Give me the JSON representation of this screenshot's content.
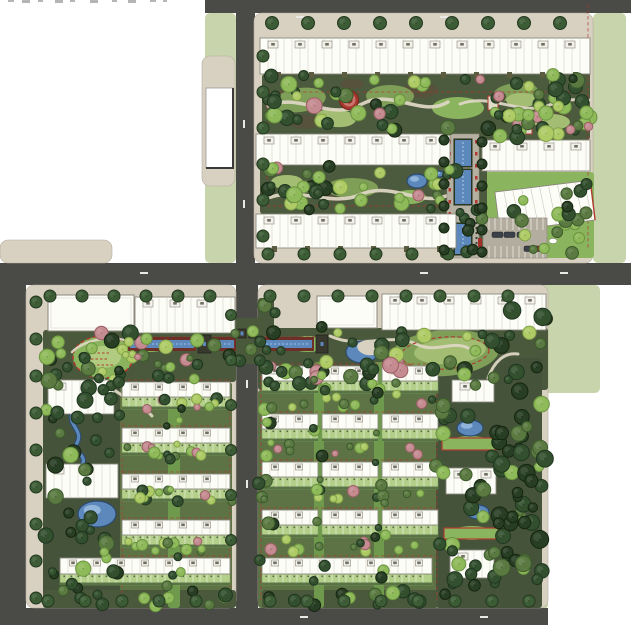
{
  "canvas": {
    "w": 631,
    "h": 625,
    "bg": "#ffffff"
  },
  "palette": {
    "road": "#4a4a47",
    "walk": "#d5cdbe",
    "sage": "#c8d4ab",
    "pad": "#d8d1c2",
    "gBase": "#4c5a3d",
    "gBand": "#4a583b",
    "gTown": "#5d7346",
    "gFinger": "#6f9a4e",
    "gTower": "#45533a",
    "lawn1": "#7f9e58",
    "lawn2": "#a3bd72",
    "lawn3": "#8ab45e",
    "lawn4": "#b1cc80",
    "soil": "#5f4a3c",
    "path": "#ddd6c2",
    "red": "#b03a30",
    "darkRed": "#6e2f28",
    "water": "#5c88bb",
    "waterDark": "#2c4a6e",
    "waterLight": "#9fc0e2",
    "bldg": "#fdfdf8",
    "bldgLine": "#8a877c",
    "bldgInner": "#c9c6ba",
    "bldgDark": "#6f6f62",
    "olive": "#5c5c40",
    "plot": "#b3cf8a",
    "plotLine": "#e8efdc",
    "plotDark": "#4a643c",
    "plotDot": "#55684a",
    "structure": "#38382f",
    "car": "#3b4049",
    "carRed": "#7a2e28",
    "parking": "#b3ada0",
    "trees": {
      "dark": [
        "#33502e",
        "#1f3520"
      ],
      "deep": [
        "#283e24",
        "#15250f"
      ],
      "mid": [
        "#5a7a41",
        "#3c5a2c"
      ],
      "light": [
        "#8fba5a",
        "#6a9440"
      ],
      "yellow": [
        "#aecb66",
        "#83a34b"
      ],
      "pink": [
        "#c48b90",
        "#9c6066"
      ],
      "street": [
        "#3c5c35",
        "#24391f"
      ]
    },
    "kindsets": {
      "mixed": [
        "dark",
        "deep",
        "mid",
        "light",
        "yellow",
        "dark",
        "light",
        "pink"
      ],
      "mixed2": [
        "dark",
        "mid",
        "light",
        "yellow"
      ],
      "darkish": [
        "dark",
        "deep",
        "dark",
        "mid",
        "light"
      ],
      "deepish": [
        "deep",
        "dark",
        "deep",
        "mid"
      ],
      "band": [
        "light",
        "yellow",
        "dark",
        "mid",
        "pink"
      ]
    }
  },
  "sage": [
    [
      205,
      13,
      31,
      250
    ],
    [
      593,
      13,
      33,
      250
    ],
    [
      505,
      285,
      95,
      108
    ],
    [
      505,
      393,
      43,
      217
    ]
  ],
  "roads": [
    [
      205,
      0,
      426,
      13
    ],
    [
      236,
      12,
      19,
      253
    ],
    [
      0,
      263,
      631,
      22
    ],
    [
      0,
      285,
      26,
      325
    ],
    [
      236,
      285,
      22,
      325
    ],
    [
      0,
      608,
      548,
      17
    ]
  ],
  "pads": [
    [
      202,
      56,
      33,
      130
    ],
    [
      0,
      240,
      112,
      23
    ],
    [
      254,
      13,
      339,
      250
    ],
    [
      26,
      285,
      210,
      323
    ],
    [
      258,
      285,
      290,
      323
    ]
  ],
  "zones": [
    {
      "r": [
        262,
        74,
        324,
        62
      ],
      "c": "gBase"
    },
    {
      "r": [
        260,
        164,
        198,
        50
      ],
      "c": "gBase"
    },
    {
      "r": [
        478,
        70,
        112,
        70
      ],
      "c": "gBase"
    },
    {
      "r": [
        478,
        172,
        116,
        86
      ],
      "c": "lawn3"
    },
    {
      "r": [
        43,
        330,
        193,
        52
      ],
      "c": "gBand"
    },
    {
      "r": [
        43,
        380,
        77,
        228
      ],
      "c": "gTower"
    },
    {
      "r": [
        120,
        382,
        112,
        226
      ],
      "c": "gTown"
    },
    {
      "r": [
        258,
        328,
        290,
        62
      ],
      "c": "gBand"
    },
    {
      "r": [
        258,
        390,
        180,
        218
      ],
      "c": "gTown"
    },
    {
      "r": [
        436,
        358,
        106,
        250
      ],
      "c": "gTower"
    },
    {
      "r": [
        258,
        298,
        16,
        30
      ],
      "c": "gBand"
    },
    {
      "r": [
        232,
        318,
        30,
        46
      ],
      "c": "gBand"
    },
    {
      "r": [
        440,
        134,
        7,
        124
      ],
      "c": "gBase"
    },
    {
      "r": [
        479,
        134,
        8,
        124
      ],
      "c": "gBase"
    },
    {
      "r": [
        43,
        590,
        193,
        18
      ],
      "c": "gBand"
    },
    {
      "r": [
        262,
        590,
        176,
        18
      ],
      "c": "gBand"
    }
  ],
  "fingers": [
    [
      168,
      382,
      12,
      226
    ],
    [
      314,
      362,
      10,
      246
    ],
    [
      374,
      362,
      10,
      246
    ]
  ],
  "soil": [
    [
      305,
      122,
      16,
      7
    ],
    [
      420,
      90,
      18,
      8
    ],
    [
      556,
      115,
      14,
      6
    ],
    [
      352,
      84,
      12,
      5
    ],
    [
      336,
      196,
      14,
      6
    ]
  ],
  "lawns": [
    [
      300,
      100,
      26,
      12,
      "lawn1",
      -8
    ],
    [
      336,
      118,
      20,
      9,
      "lawn2",
      5
    ],
    [
      390,
      96,
      24,
      11,
      "lawn1",
      0
    ],
    [
      458,
      108,
      26,
      11,
      "lawn3",
      0
    ],
    [
      516,
      92,
      22,
      9,
      "lawn1",
      -5
    ],
    [
      552,
      122,
      18,
      8,
      "lawn2",
      0
    ],
    [
      287,
      182,
      16,
      7,
      "lawn2",
      0
    ],
    [
      352,
      188,
      26,
      10,
      "lawn1",
      0
    ],
    [
      410,
      197,
      16,
      7,
      "lawn3",
      0
    ],
    [
      522,
      100,
      16,
      7,
      "lawn2",
      0
    ],
    [
      150,
      345,
      18,
      7,
      "lawn3",
      0
    ],
    [
      445,
      353,
      54,
      23,
      "lawn1",
      -4
    ],
    [
      450,
      351,
      36,
      13,
      "lawn2",
      -4
    ],
    [
      308,
      344,
      20,
      8,
      "lawn3",
      0
    ],
    [
      470,
      443,
      20,
      7,
      "lawn3",
      0
    ],
    [
      472,
      533,
      20,
      7,
      "lawn3",
      0
    ],
    [
      548,
      240,
      24,
      12,
      "lawn3",
      0
    ]
  ],
  "track": {
    "cx": 103,
    "cy": 357,
    "rx": 30,
    "ry": 21
  },
  "paths": [
    [
      "M268,106 C300,92 330,122 362,104 C392,88 422,118 448,102",
      3.5
    ],
    [
      "M460,104 C492,92 522,118 552,104 C572,96 584,102 590,100",
      3
    ],
    [
      "M268,198 C300,186 332,208 362,194 C392,182 420,206 446,196",
      3.5
    ],
    [
      "M104,380 C116,396 140,402 152,416",
      3
    ],
    [
      "M330,336 C360,350 392,332 416,344 C436,354 452,340 468,348",
      3
    ],
    [
      "M488,378 C494,362 504,352 518,354",
      3
    ],
    [
      "M72,352 C86,338 118,334 134,344",
      2.5
    ]
  ],
  "red_lines": [
    [
      588,
      4,
      588,
      248
    ],
    [
      267,
      92,
      585,
      92
    ],
    [
      267,
      92,
      267,
      206
    ],
    [
      267,
      206,
      450,
      206
    ],
    [
      130,
      337,
      234,
      337
    ],
    [
      258,
      337,
      316,
      337
    ],
    [
      122,
      380,
      230,
      380
    ],
    [
      122,
      426,
      230,
      426
    ],
    [
      122,
      472,
      230,
      472
    ],
    [
      122,
      518,
      230,
      518
    ],
    [
      122,
      556,
      230,
      556
    ],
    [
      122,
      380,
      122,
      600
    ],
    [
      230,
      380,
      230,
      600
    ],
    [
      261,
      364,
      437,
      364
    ],
    [
      261,
      412,
      437,
      412
    ],
    [
      261,
      460,
      437,
      460
    ],
    [
      261,
      508,
      437,
      508
    ],
    [
      261,
      556,
      437,
      556
    ],
    [
      261,
      364,
      261,
      600
    ],
    [
      437,
      364,
      437,
      600
    ],
    [
      480,
      60,
      586,
      60
    ]
  ],
  "red_loop": {
    "cx": 445,
    "cy": 353,
    "rx": 44,
    "ry": 16,
    "rot": -4
  },
  "pergolas": [
    [
      442,
      438,
      54,
      12
    ],
    [
      444,
      528,
      54,
      11
    ]
  ],
  "pavilions_red": [
    [
      488,
      96,
      10,
      14
    ],
    [
      524,
      124,
      8,
      10
    ]
  ],
  "linear_water": [
    [
      128,
      337,
      68,
      14
    ],
    [
      212,
      337,
      24,
      14
    ],
    [
      262,
      337,
      52,
      14
    ]
  ],
  "ponds": [
    [
      417,
      181,
      10,
      7
    ],
    [
      439,
      174,
      5,
      3
    ],
    [
      97,
      514,
      19,
      13
    ],
    [
      470,
      428,
      13,
      8
    ],
    [
      478,
      512,
      11,
      7
    ]
  ],
  "crescent": {
    "cx": 362,
    "cy": 352,
    "rx": 16,
    "ry": 11,
    "hx": 368,
    "hy": 348,
    "hrx": 11,
    "hry": 7
  },
  "stream": "M73,412 C66,424 84,430 77,443 C72,452 86,454 83,463",
  "axis": {
    "pad": [
      447,
      134,
      32,
      124
    ],
    "waters": [
      [
        455,
        140,
        16,
        26
      ],
      [
        455,
        170,
        16,
        34
      ],
      [
        455,
        224,
        16,
        30
      ]
    ],
    "ticksY": [
      140,
      152,
      164,
      176,
      188,
      200,
      212
    ],
    "colY": [
      218,
      254,
      5
    ],
    "gates": [
      [
        446,
        238,
        4,
        9
      ],
      [
        478,
        238,
        4,
        9
      ]
    ]
  },
  "plain_buildings": [
    [
      48,
      295,
      86,
      36
    ],
    [
      317,
      296,
      60,
      32
    ]
  ],
  "tl_building": {
    "x": 206,
    "y": 88,
    "w": 27,
    "h": 80
  },
  "slabs": [
    [
      260,
      38,
      330,
      36,
      1
    ],
    [
      256,
      134,
      194,
      31,
      0
    ],
    [
      482,
      140,
      108,
      31,
      0
    ],
    [
      256,
      214,
      200,
      34,
      1
    ],
    [
      135,
      297,
      100,
      36,
      0
    ],
    [
      382,
      294,
      164,
      36,
      0
    ],
    [
      48,
      380,
      66,
      34,
      0
    ],
    [
      46,
      464,
      72,
      34,
      0
    ],
    [
      122,
      382,
      108,
      15,
      0
    ],
    [
      122,
      428,
      108,
      15,
      0
    ],
    [
      122,
      474,
      108,
      15,
      0
    ],
    [
      122,
      520,
      108,
      15,
      0
    ],
    [
      60,
      558,
      170,
      16,
      0
    ],
    [
      262,
      366,
      56,
      15,
      0
    ],
    [
      322,
      366,
      56,
      15,
      0
    ],
    [
      382,
      366,
      56,
      15,
      0
    ],
    [
      262,
      414,
      56,
      15,
      0
    ],
    [
      322,
      414,
      56,
      15,
      0
    ],
    [
      382,
      414,
      56,
      15,
      0
    ],
    [
      262,
      462,
      56,
      15,
      0
    ],
    [
      322,
      462,
      56,
      15,
      0
    ],
    [
      382,
      462,
      56,
      15,
      0
    ],
    [
      262,
      510,
      56,
      15,
      0
    ],
    [
      322,
      510,
      56,
      15,
      0
    ],
    [
      382,
      510,
      56,
      15,
      0
    ],
    [
      262,
      558,
      170,
      16,
      0
    ],
    [
      452,
      380,
      42,
      22,
      0
    ],
    [
      446,
      468,
      50,
      26,
      0
    ],
    [
      450,
      550,
      44,
      28,
      0
    ]
  ],
  "clubhouse": {
    "x": 497,
    "y": 186,
    "w": 96,
    "h": 40,
    "rot": -7
  },
  "plots": [
    [
      122,
      397,
      108,
      12
    ],
    [
      122,
      443,
      108,
      12
    ],
    [
      122,
      489,
      108,
      12
    ],
    [
      122,
      535,
      108,
      12
    ],
    [
      60,
      574,
      170,
      11
    ],
    [
      262,
      381,
      56,
      12
    ],
    [
      322,
      381,
      56,
      12
    ],
    [
      382,
      381,
      56,
      12
    ],
    [
      262,
      429,
      56,
      12
    ],
    [
      322,
      429,
      56,
      12
    ],
    [
      382,
      429,
      56,
      12
    ],
    [
      262,
      477,
      56,
      12
    ],
    [
      322,
      477,
      56,
      12
    ],
    [
      382,
      477,
      56,
      12
    ],
    [
      262,
      525,
      56,
      12
    ],
    [
      322,
      525,
      56,
      12
    ],
    [
      382,
      525,
      56,
      12
    ],
    [
      262,
      574,
      170,
      11
    ]
  ],
  "parking": {
    "x": 483,
    "y": 218,
    "w": 64,
    "h": 40
  },
  "cars": [
    [
      492,
      232,
      0
    ],
    [
      504,
      232,
      0
    ],
    [
      517,
      232,
      0
    ],
    [
      524,
      246,
      0
    ],
    [
      535,
      246,
      1
    ]
  ],
  "structures": [
    [
      198,
      335,
      13,
      18
    ],
    [
      316,
      335,
      12,
      18
    ],
    [
      238,
      329,
      8,
      9
    ],
    [
      249,
      329,
      8,
      9
    ]
  ],
  "plaza": {
    "cx": 349,
    "cy": 100
  },
  "sculpture": {
    "cx": 553,
    "cy": 241,
    "rx": 4,
    "ry": 2.5
  },
  "tree_rows": [
    {
      "x": 272,
      "y": 23,
      "dx": 36,
      "dy": 0,
      "n": 9,
      "k": "street",
      "r": 6.5
    },
    {
      "x": 263,
      "y": 56,
      "dx": 0,
      "dy": 36,
      "n": 6,
      "k": "street",
      "r": 6
    },
    {
      "x": 268,
      "y": 254,
      "dx": 36,
      "dy": 0,
      "n": 6,
      "k": "street",
      "r": 6
    },
    {
      "x": 50,
      "y": 296,
      "dx": 32,
      "dy": 0,
      "n": 6,
      "k": "street",
      "r": 6
    },
    {
      "x": 270,
      "y": 296,
      "dx": 34,
      "dy": 0,
      "n": 8,
      "k": "street",
      "r": 6
    },
    {
      "x": 36,
      "y": 302,
      "dx": 0,
      "dy": 37,
      "n": 9,
      "k": "street",
      "r": 6
    },
    {
      "x": 231,
      "y": 315,
      "dx": 0,
      "dy": 45,
      "n": 6,
      "k": "street",
      "r": 5.5
    },
    {
      "x": 48,
      "y": 601,
      "dx": 37,
      "dy": 0,
      "n": 5,
      "k": "street",
      "r": 6
    },
    {
      "x": 270,
      "y": 601,
      "dx": 37,
      "dy": 0,
      "n": 8,
      "k": "street",
      "r": 6
    },
    {
      "x": 444,
      "y": 140,
      "dx": 0,
      "dy": 22,
      "n": 6,
      "k": "deep",
      "r": 5
    },
    {
      "x": 482,
      "y": 142,
      "dx": 0,
      "dy": 22,
      "n": 6,
      "k": "deep",
      "r": 5
    }
  ],
  "tree_scatter": [
    [
      262,
      74,
      324,
      60,
      55,
      "mixed",
      4,
      8
    ],
    [
      260,
      164,
      196,
      48,
      38,
      "mixed",
      4,
      8
    ],
    [
      478,
      70,
      112,
      68,
      26,
      "mixed",
      4,
      8
    ],
    [
      478,
      196,
      116,
      58,
      13,
      "mixed2",
      4,
      7
    ],
    [
      558,
      176,
      36,
      48,
      8,
      "darkish",
      4,
      7
    ],
    [
      43,
      330,
      193,
      50,
      32,
      "mixed",
      4,
      8
    ],
    [
      43,
      380,
      77,
      226,
      42,
      "darkish",
      4,
      8
    ],
    [
      120,
      352,
      112,
      16,
      9,
      "band",
      3,
      6
    ],
    [
      120,
      398,
      112,
      14,
      9,
      "band",
      3,
      6
    ],
    [
      120,
      444,
      112,
      14,
      9,
      "band",
      3,
      6
    ],
    [
      120,
      490,
      112,
      14,
      9,
      "band",
      3,
      6
    ],
    [
      120,
      536,
      112,
      18,
      11,
      "band",
      3,
      6
    ],
    [
      55,
      590,
      178,
      16,
      11,
      "darkish",
      4,
      7
    ],
    [
      166,
      382,
      16,
      222,
      13,
      "darkish",
      3,
      6
    ],
    [
      258,
      326,
      290,
      58,
      44,
      "mixed",
      4,
      8
    ],
    [
      260,
      394,
      178,
      14,
      10,
      "band",
      3,
      6
    ],
    [
      260,
      442,
      178,
      14,
      10,
      "band",
      3,
      6
    ],
    [
      260,
      490,
      178,
      14,
      10,
      "band",
      3,
      6
    ],
    [
      260,
      536,
      178,
      16,
      12,
      "band",
      3,
      6
    ],
    [
      262,
      590,
      176,
      16,
      11,
      "darkish",
      4,
      7
    ],
    [
      312,
      360,
      14,
      230,
      13,
      "darkish",
      3,
      6
    ],
    [
      372,
      360,
      14,
      230,
      13,
      "darkish",
      3,
      6
    ],
    [
      436,
      358,
      106,
      246,
      48,
      "darkish",
      4,
      8
    ],
    [
      492,
      292,
      54,
      308,
      38,
      "deepish",
      5,
      9
    ],
    [
      258,
      298,
      18,
      290,
      15,
      "darkish",
      4,
      7
    ],
    [
      232,
      320,
      30,
      42,
      5,
      "darkish",
      4,
      6
    ],
    [
      455,
      196,
      24,
      58,
      8,
      "darkish",
      4,
      6
    ]
  ],
  "road_dashes": [
    [
      296,
      16,
      8,
      2
    ],
    [
      440,
      16,
      8,
      2
    ],
    [
      243,
      120,
      2,
      8
    ],
    [
      243,
      200,
      2,
      8
    ],
    [
      140,
      272,
      8,
      2
    ],
    [
      420,
      272,
      8,
      2
    ],
    [
      560,
      272,
      8,
      2
    ],
    [
      246,
      380,
      2,
      8
    ],
    [
      246,
      480,
      2,
      8
    ],
    [
      300,
      616,
      8,
      2
    ],
    [
      480,
      616,
      8,
      2
    ]
  ],
  "edge_marks": [
    [
      8,
      0,
      6,
      2
    ],
    [
      22,
      0,
      8,
      3
    ],
    [
      38,
      0,
      5,
      2
    ],
    [
      55,
      0,
      8,
      3
    ],
    [
      70,
      0,
      5,
      2
    ],
    [
      90,
      0,
      8,
      3
    ],
    [
      112,
      0,
      5,
      2
    ],
    [
      128,
      0,
      8,
      3
    ],
    [
      150,
      0,
      6,
      2
    ],
    [
      163,
      0,
      4,
      2
    ]
  ]
}
